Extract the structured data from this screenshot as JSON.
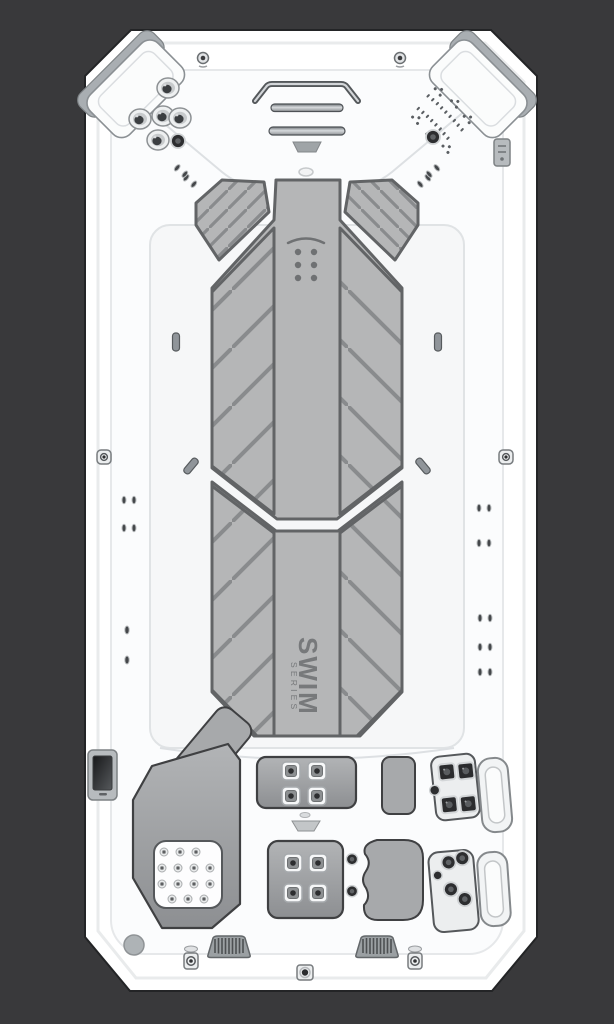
{
  "meta": {
    "description": "Top-down product view of a white SWIM Series swim spa with gray tread mats, corner headrests, hydrotherapy jets, grab rails and a touchscreen control panel",
    "view": "top-down"
  },
  "branding": {
    "name": "SWIM",
    "series": "SERIES"
  },
  "colors": {
    "bg": "#39393b",
    "shell": "#ffffff",
    "shell_edge": "#e9ebec",
    "shell_shadow": "#232426",
    "contour": "#dde0e3",
    "mat": "#b5b6b7",
    "mat_border": "#626466",
    "mat_stripe": "#898b8d",
    "lane_marker": "#6f7173",
    "text": "#77797b",
    "seat": "#a7a9ab",
    "outline_dark": "#3f4042",
    "chrome_dark": "#54585b",
    "chrome_light": "#d3d6d9",
    "jet_dark": "#2d2e30",
    "panel_frame": "#b7bbbe",
    "screen": "#222325"
  },
  "features": {
    "headrests": 2,
    "corner_jets_left": 6,
    "grab_rails": 2,
    "tread_mats": 2,
    "lane_marker_dots": 6,
    "center_seatbacks": 2,
    "square_jets_per_seatback": 4,
    "seat_pad_jets": 14,
    "right_jet_panels": 2,
    "grab_handles": 2,
    "speaker_grilles": 2,
    "control_panel": 1
  }
}
